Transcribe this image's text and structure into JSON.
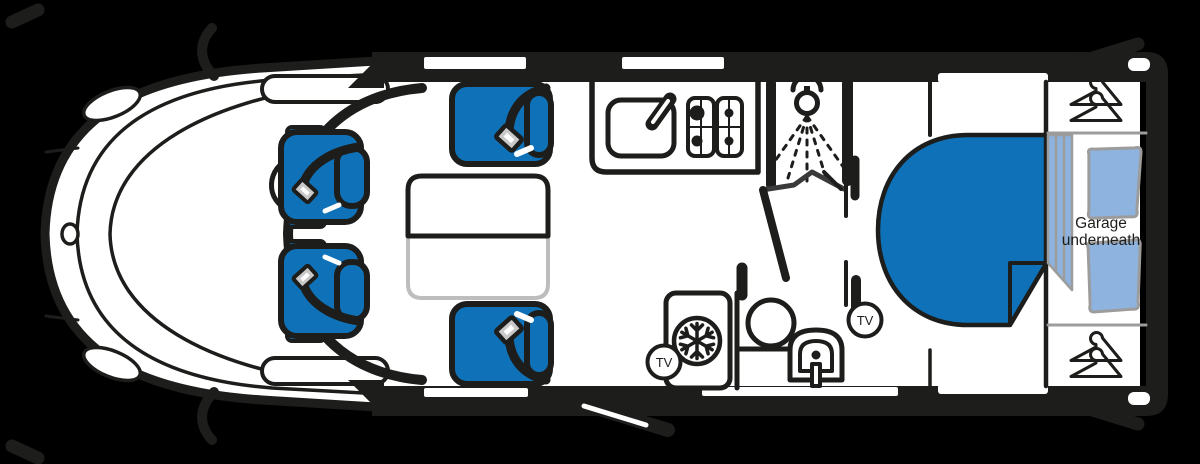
{
  "canvas": {
    "width": 1200,
    "height": 464
  },
  "colors": {
    "background": "#000000",
    "line": "#1d1d1b",
    "white": "#ffffff",
    "blue": "#0f72b8",
    "light_blue": "#8eb3de",
    "sketch_gray": "#9c9c9c",
    "buckle_gray": "#c9c9c9",
    "door_gray": "#3a3a3a",
    "table_edge_gray": "#bdbdbd"
  },
  "labels": {
    "garage_line1": "Garage",
    "garage_line2": "underneath",
    "tv_lounge": "TV",
    "tv_bedroom": "TV"
  },
  "icons": {
    "snowflake": "fridge-freezer",
    "hanger": "wardrobe",
    "shower_head": "shower",
    "seatbelt": "belted-travel-seat",
    "tv_badge": "tv-point"
  }
}
